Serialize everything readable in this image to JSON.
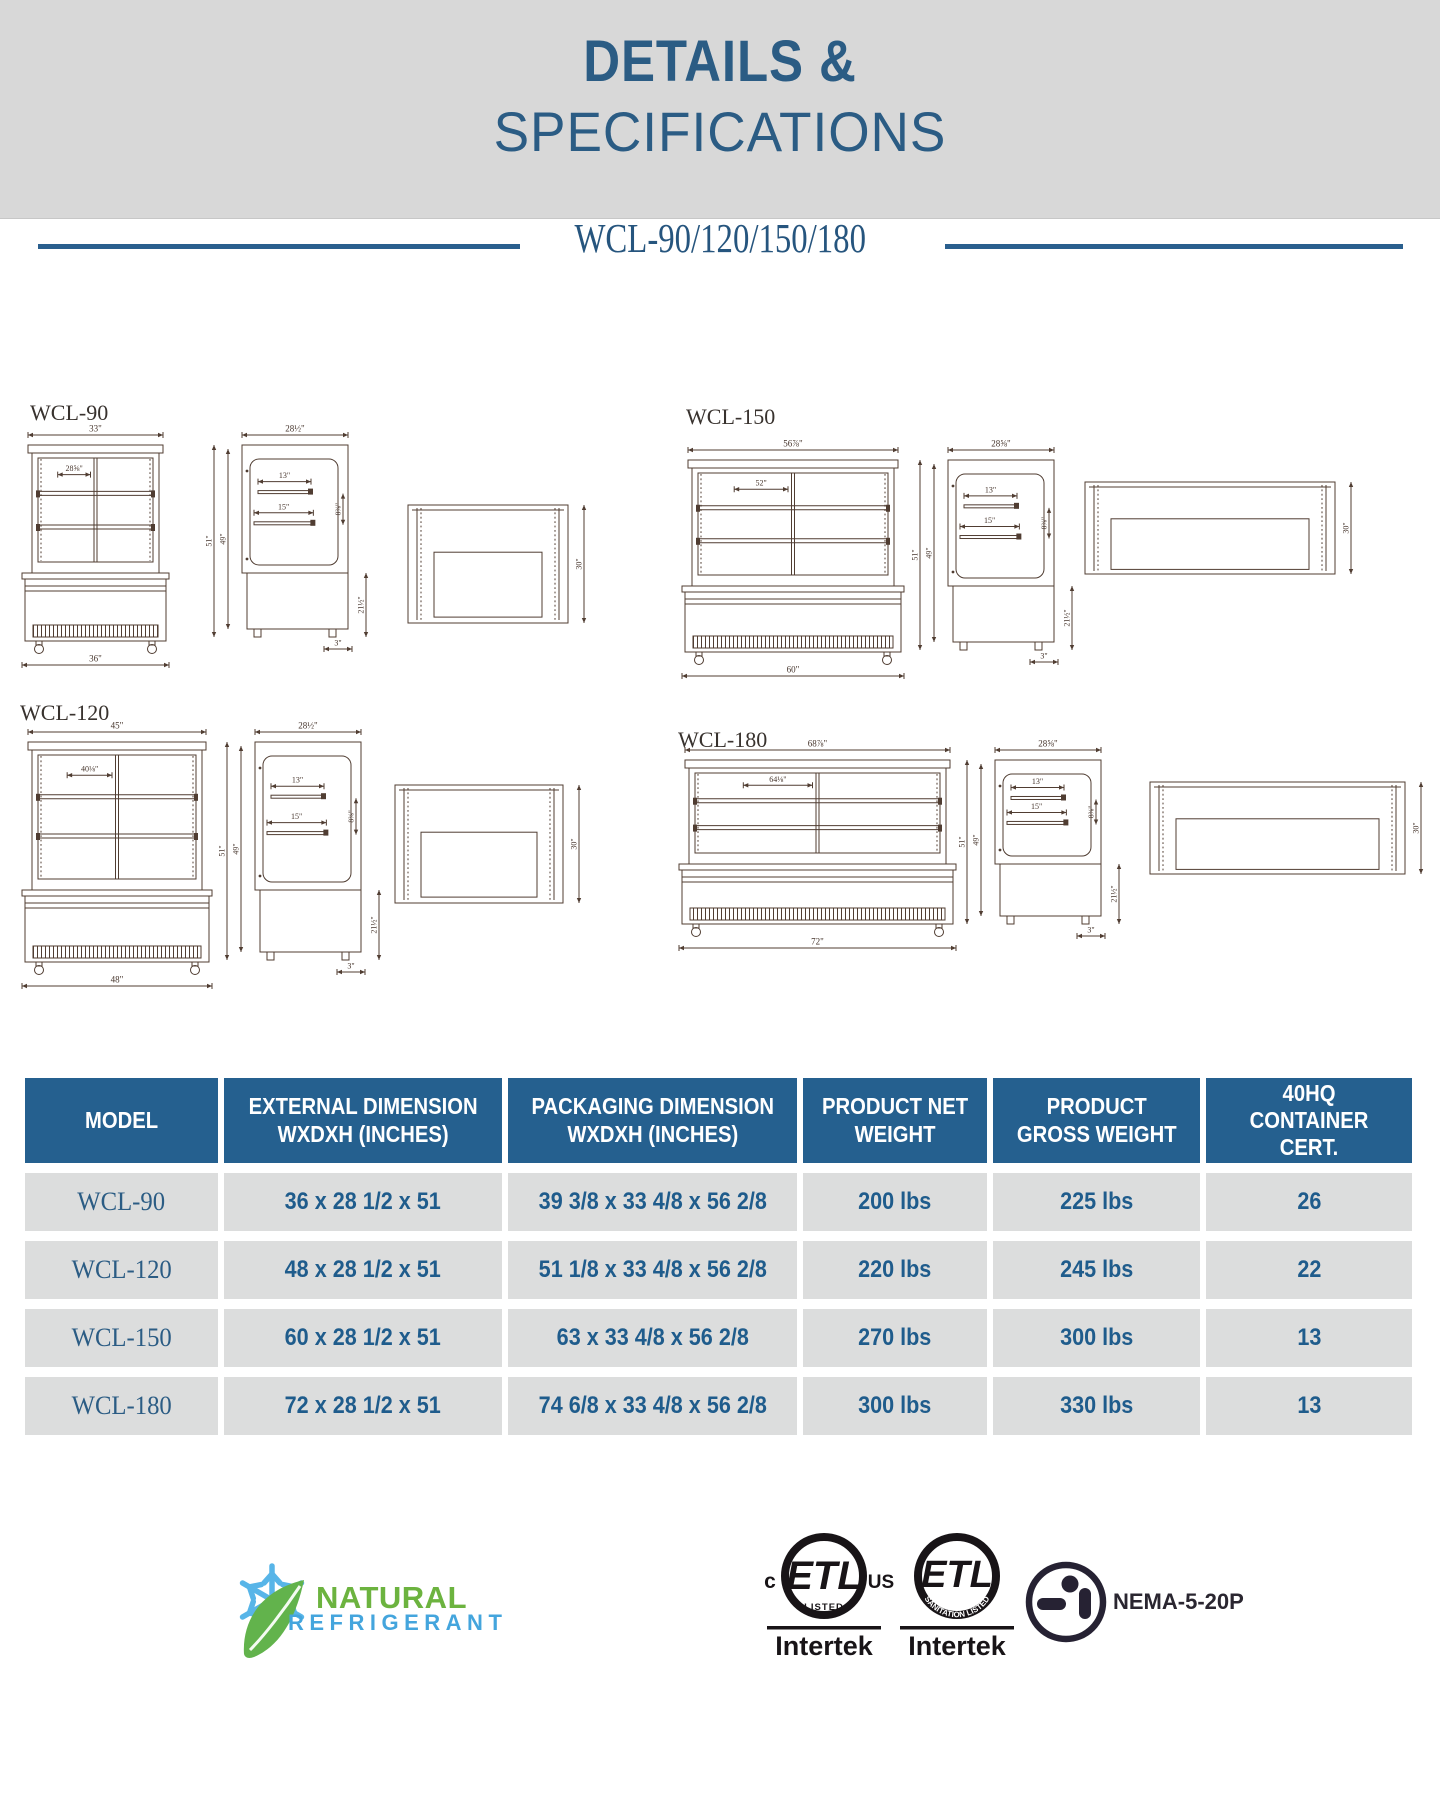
{
  "header": {
    "title_line1": "DETAILS &",
    "title_line2": "SPECIFICATIONS",
    "accent": "#2b5c84",
    "band_bg": "#d8d8d8"
  },
  "subtitle": {
    "text": "WCL-90/120/150/180",
    "rule_color": "#2a5f8e"
  },
  "drawing": {
    "line_color": "#503d32"
  },
  "diagrams": [
    {
      "id": "wcl-90",
      "label": "WCL-90",
      "front": {
        "top": "33\"",
        "inner": "28⅝\"",
        "bottom": "36\""
      },
      "side": {
        "depth": "28½\"",
        "shelf1": "13\"",
        "shelf2": "15\"",
        "gap": "8⅜\"",
        "h1": "51\"",
        "h2": "49\"",
        "base": "21½\"",
        "foot": "3\""
      },
      "persp": {
        "height": "30\""
      }
    },
    {
      "id": "wcl-150",
      "label": "WCL-150",
      "front": {
        "top": "56⅞\"",
        "inner": "52\"",
        "bottom": "60\""
      },
      "side": {
        "depth": "28⅝\"",
        "shelf1": "13\"",
        "shelf2": "15\"",
        "gap": "8⅜\"",
        "h1": "51\"",
        "h2": "49\"",
        "base": "21½\"",
        "foot": "3\""
      },
      "persp": {
        "height": "30\""
      }
    },
    {
      "id": "wcl-120",
      "label": "WCL-120",
      "front": {
        "top": "45\"",
        "inner": "40⅛\"",
        "bottom": "48\""
      },
      "side": {
        "depth": "28½\"",
        "shelf1": "13\"",
        "shelf2": "15\"",
        "gap": "8⅜\"",
        "h1": "51\"",
        "h2": "49\"",
        "base": "21½\"",
        "foot": "3\""
      },
      "persp": {
        "height": "30\""
      }
    },
    {
      "id": "wcl-180",
      "label": "WCL-180",
      "front": {
        "top": "68⅞\"",
        "inner": "64⅛\"",
        "bottom": "72\""
      },
      "side": {
        "depth": "28⅝\"",
        "shelf1": "13\"",
        "shelf2": "15\"",
        "gap": "8⅜\"",
        "h1": "51\"",
        "h2": "49\"",
        "base": "21½\"",
        "foot": "3\""
      },
      "persp": {
        "height": "30\""
      }
    }
  ],
  "table": {
    "header_bg": "#25608f",
    "cell_bg": "#dcdddd",
    "text_color": "#1f5c8c",
    "headers": [
      "MODEL",
      "EXTERNAL DIMENSION\nWXDXH (INCHES)",
      "PACKAGING DIMENSION\nWXDXH (INCHES)",
      "PRODUCT NET\nWEIGHT",
      "PRODUCT\nGROSS WEIGHT",
      "40HQ\nCONTAINER CERT."
    ],
    "rows": [
      {
        "model": "WCL-90",
        "external": "36 x 28 1/2 x 51",
        "packaging": "39 3/8 x 33 4/8 x 56 2/8",
        "net": "200 lbs",
        "gross": "225 lbs",
        "cert": "26"
      },
      {
        "model": "WCL-120",
        "external": "48 x 28 1/2 x 51",
        "packaging": "51 1/8 x 33 4/8 x 56 2/8",
        "net": "220 lbs",
        "gross": "245 lbs",
        "cert": "22"
      },
      {
        "model": "WCL-150",
        "external": "60 x 28 1/2 x 51",
        "packaging": "63 x 33 4/8 x 56 2/8",
        "net": "270 lbs",
        "gross": "300 lbs",
        "cert": "13"
      },
      {
        "model": "WCL-180",
        "external": "72 x 28 1/2 x 51",
        "packaging": "74 6/8 x 33 4/8 x 56 2/8",
        "net": "300 lbs",
        "gross": "330 lbs",
        "cert": "13"
      }
    ]
  },
  "footer": {
    "natural": {
      "line1": "NATURAL",
      "line2": "REFRIGERANT",
      "green": "#6cb33f",
      "blue": "#44a5dd"
    },
    "etl_us": {
      "prefix": "c",
      "mark": "ETL",
      "suffix": "US",
      "listed": "LISTED",
      "brand": "Intertek"
    },
    "etl_san": {
      "mark": "ETL",
      "listed": "SANITATION LISTED",
      "brand": "Intertek"
    },
    "nema": {
      "label": "NEMA-5-20P"
    }
  }
}
